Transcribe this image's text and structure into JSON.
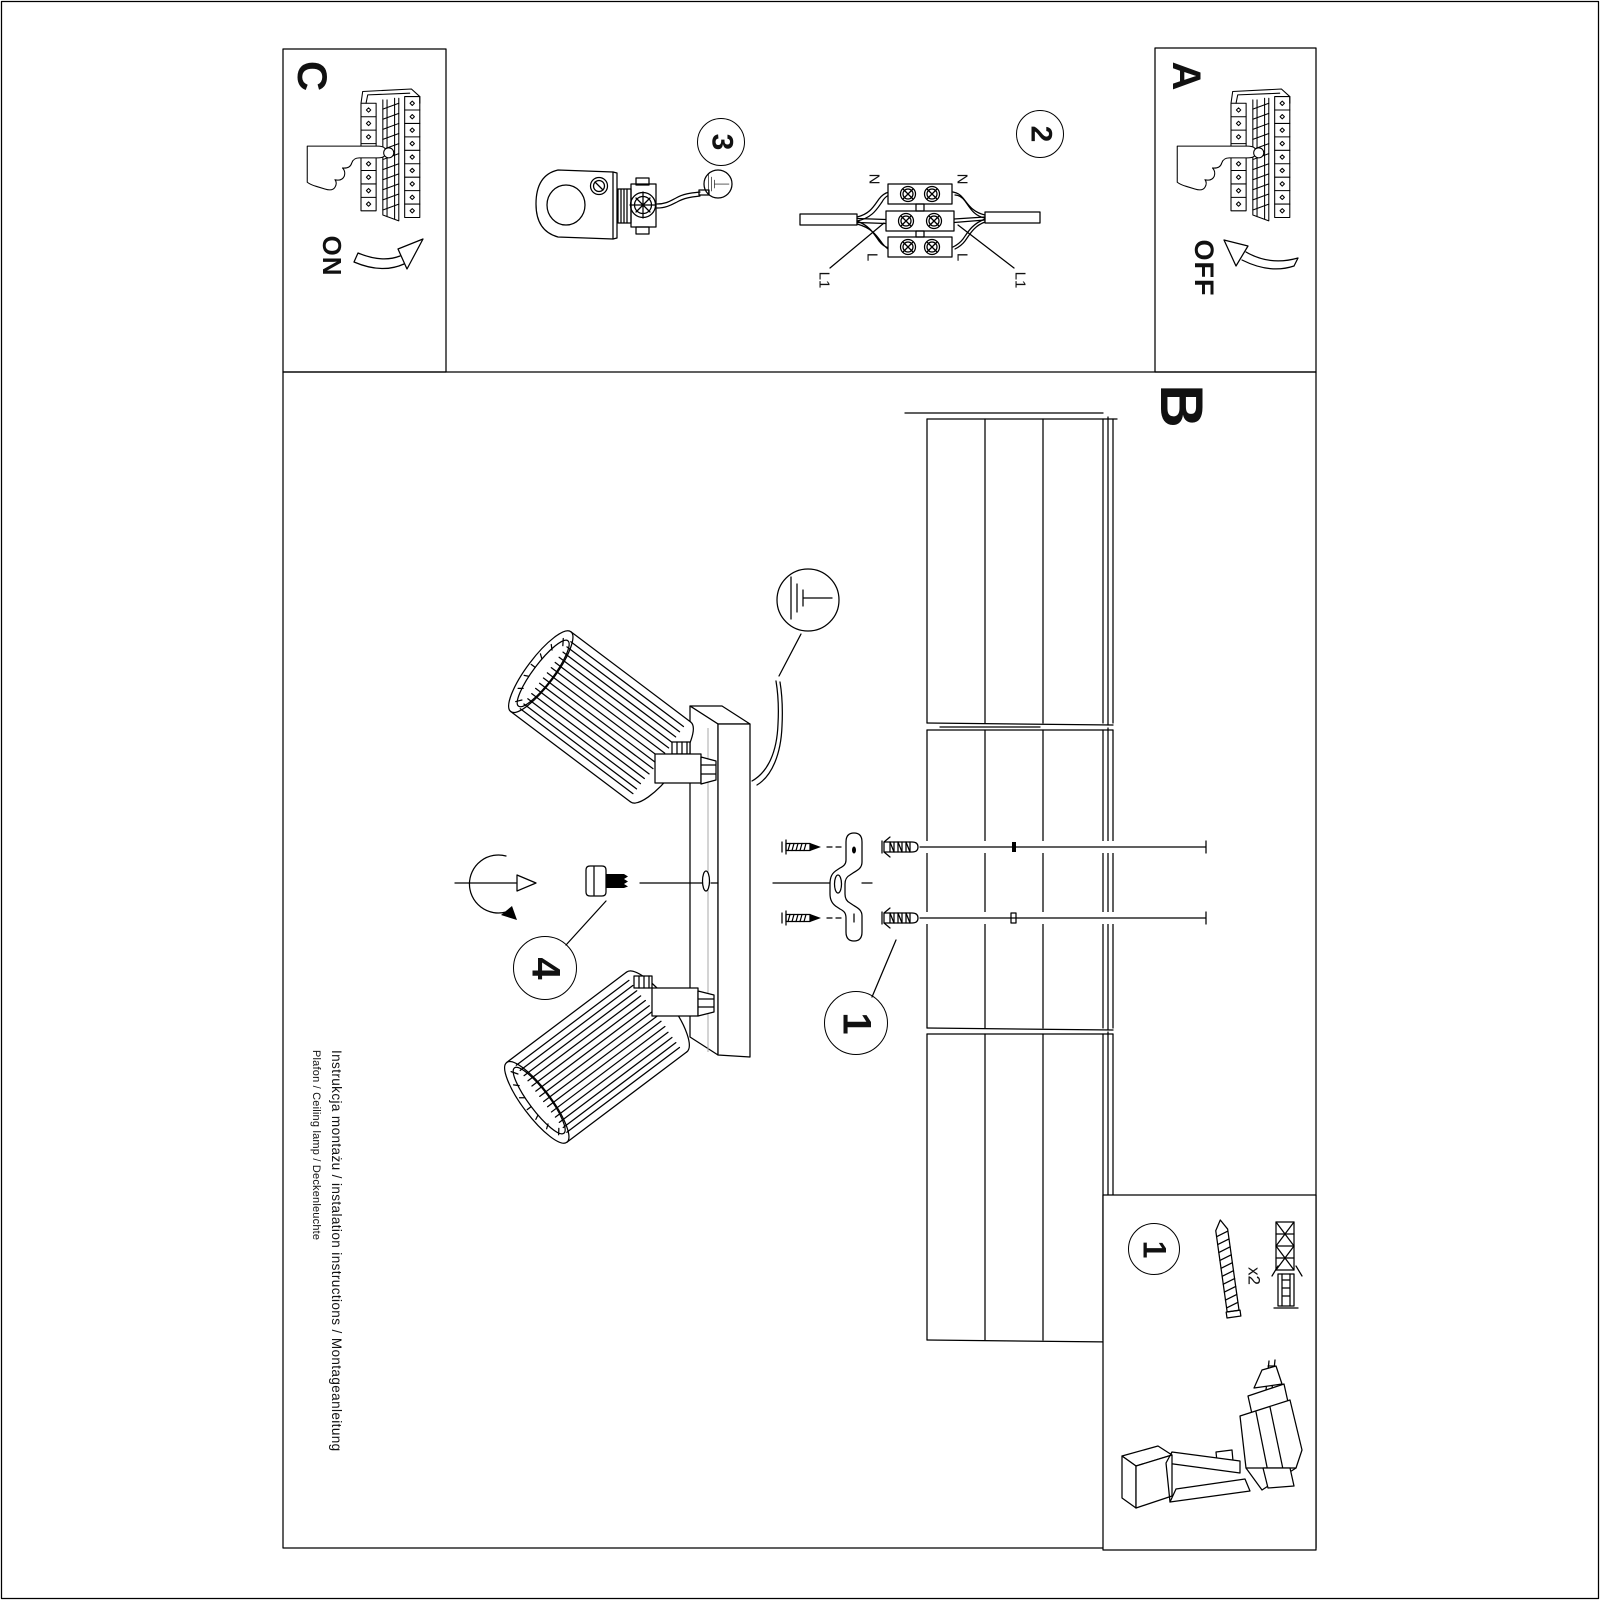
{
  "document": {
    "footer": {
      "line1": "Instrukcja montażu / instalation instructions / Montageanleitung",
      "line2": "Plafon / Ceiling lamp / Deckenleuchte"
    }
  },
  "sections": {
    "panel_a": {
      "label": "A",
      "action": "OFF"
    },
    "panel_b": {
      "label": "B"
    },
    "panel_c": {
      "label": "C",
      "action": "ON"
    },
    "step_1": {
      "label": "1"
    },
    "step_2": {
      "label": "2"
    },
    "step_3": {
      "label": "3"
    },
    "step_4": {
      "label": "4"
    }
  },
  "wiring_labels": {
    "n_left": "N",
    "n_right": "N",
    "l_left": "L",
    "l_right": "L",
    "l1_left": "L1",
    "l1_right": "L1"
  },
  "accessory_box": {
    "step_label": "1",
    "screw_quantity": "x2"
  },
  "icons": {
    "earth_large": "earth-ground-icon",
    "earth_small": "earth-ground-icon",
    "drill": "drill-icon",
    "hand_on": "hand-press-icon",
    "hand_off": "hand-press-icon"
  },
  "colors": {
    "ink": "#000000",
    "paper": "#ffffff"
  }
}
